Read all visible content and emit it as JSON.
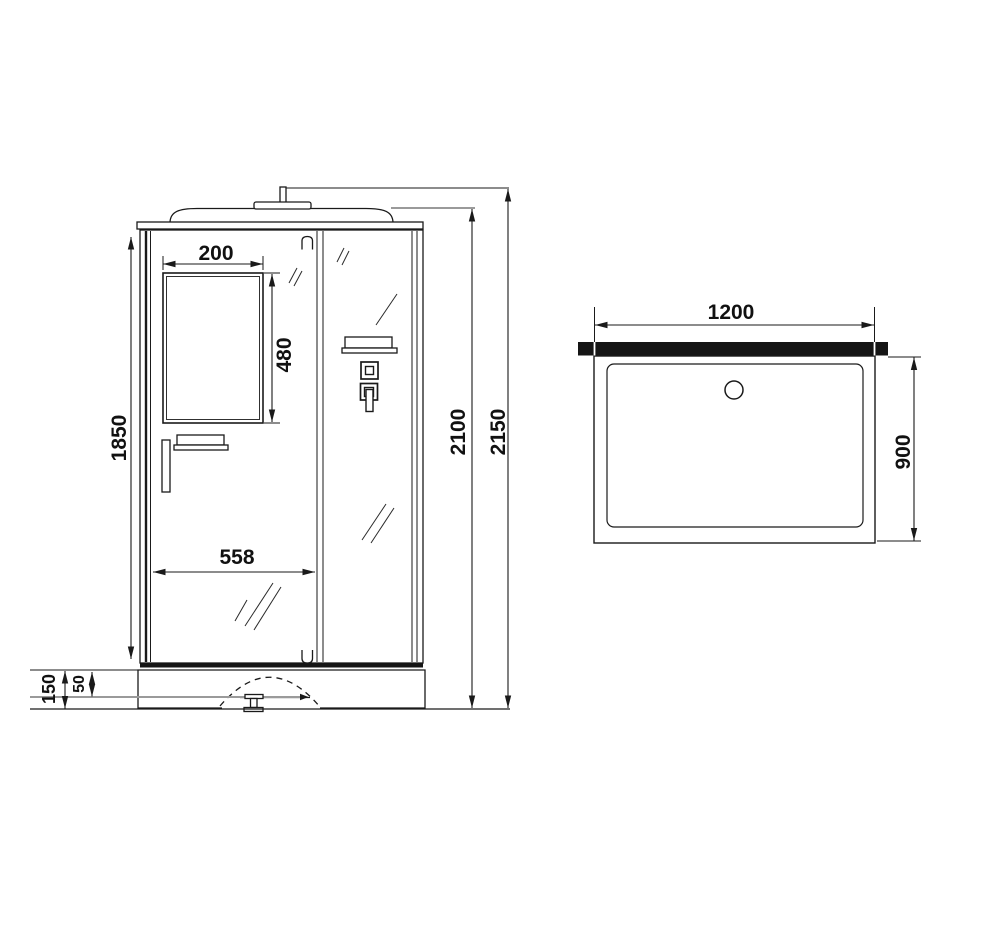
{
  "drawing_type": "shower-cabin-dimension-drawing",
  "colors": {
    "line": "#1a1a1a",
    "reference_line": "#9a9a9a",
    "wall_bar": "#151515",
    "background": "#ffffff"
  },
  "front_view": {
    "labels": {
      "mirror_width": "200",
      "mirror_height": "480",
      "opening_width": "558",
      "body_height": "1850",
      "base_height": "150",
      "tray_inner_depth": "50",
      "roof_height": "2100",
      "total_height": "2150"
    }
  },
  "top_view": {
    "labels": {
      "width": "1200",
      "depth": "900"
    }
  }
}
